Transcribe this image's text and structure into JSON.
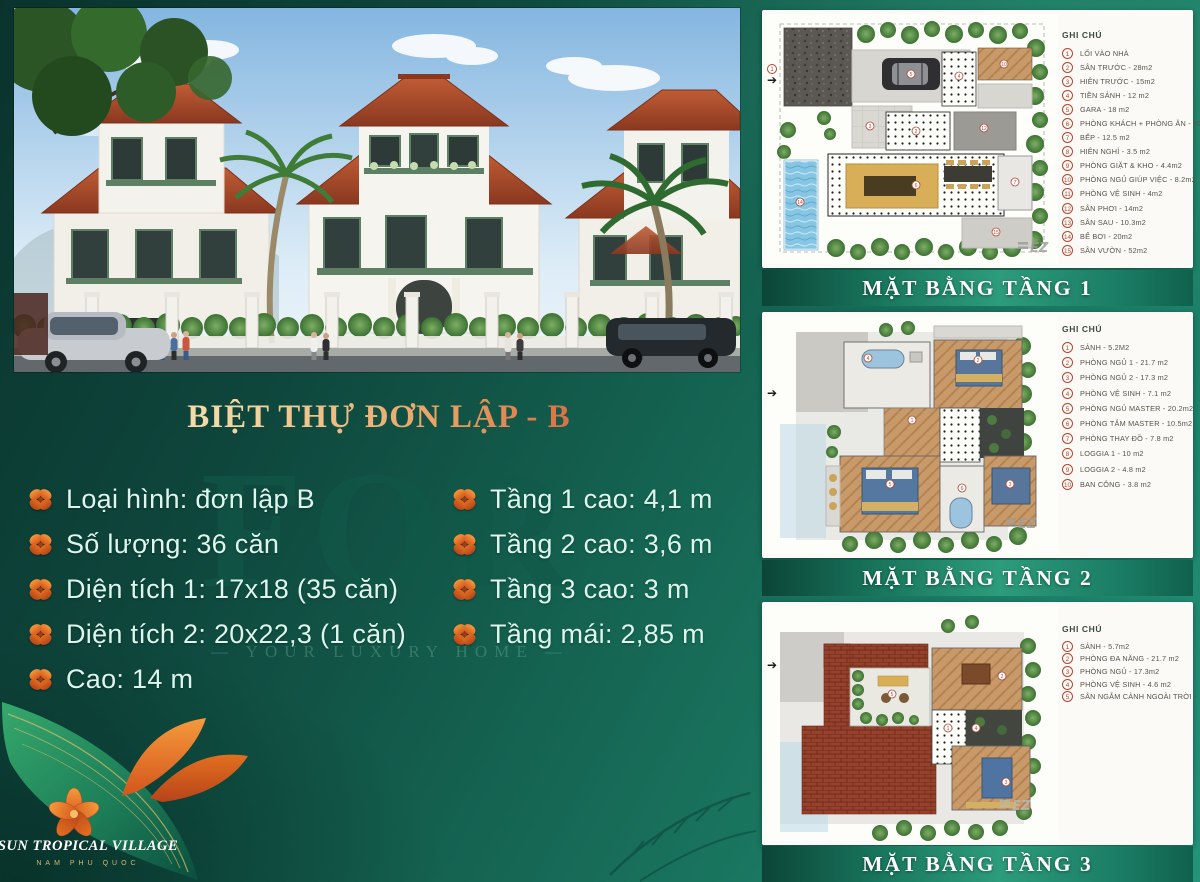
{
  "title": "BIỆT THỰ ĐƠN LẬP - B",
  "watermark": {
    "big": "FOR",
    "small": "— YOUR LUXURY HOME —"
  },
  "specs": {
    "left": [
      "Loại hình: đơn lập B",
      "Số lượng: 36 căn",
      "Diện tích 1: 17x18 (35 căn)",
      "Diện tích 2: 20x22,3 (1 căn)",
      "Cao: 14 m"
    ],
    "right": [
      "Tầng 1 cao: 4,1 m",
      "Tầng 2 cao: 3,6 m",
      "Tầng 3 cao: 3 m",
      "Tầng mái: 2,85 m"
    ]
  },
  "logo": {
    "name": "SUN TROPICAL VILLAGE",
    "subtitle": "NAM PHU QUOC"
  },
  "plans": [
    {
      "caption": "MẶT BẰNG TẦNG 1",
      "legend_title": "GHI CHÚ",
      "brand_mark": "EZ",
      "legend": [
        {
          "num": "1",
          "label": "LỐI VÀO NHÀ"
        },
        {
          "num": "2",
          "label": "SÂN TRƯỚC - 28m2"
        },
        {
          "num": "3",
          "label": "HIÊN TRƯỚC - 15m2"
        },
        {
          "num": "4",
          "label": "TIỀN SẢNH - 12 m2"
        },
        {
          "num": "5",
          "label": "GARA - 18 m2"
        },
        {
          "num": "6",
          "label": "PHÒNG KHÁCH + PHÒNG ĂN - 40 m2"
        },
        {
          "num": "7",
          "label": "BẾP - 12.5 m2"
        },
        {
          "num": "8",
          "label": "HIÊN NGHỈ - 3.5 m2"
        },
        {
          "num": "9",
          "label": "PHÒNG GIẶT & KHO - 4.4m2"
        },
        {
          "num": "10",
          "label": "PHÒNG NGỦ GIÚP VIỆC - 8.2m2"
        },
        {
          "num": "11",
          "label": "PHÒNG VỆ SINH - 4m2"
        },
        {
          "num": "12",
          "label": "SÂN PHƠI - 14m2"
        },
        {
          "num": "13",
          "label": "SÂN SAU - 10.3m2"
        },
        {
          "num": "14",
          "label": "BỂ BƠI - 20m2"
        },
        {
          "num": "15",
          "label": "SÂN VƯỜN - 52m2"
        }
      ]
    },
    {
      "caption": "MẶT BẰNG TẦNG 2",
      "legend_title": "GHI CHÚ",
      "brand_mark": "EZ",
      "legend": [
        {
          "num": "1",
          "label": "SẢNH - 5.2M2"
        },
        {
          "num": "2",
          "label": "PHÒNG NGỦ 1 - 21.7 m2"
        },
        {
          "num": "3",
          "label": "PHÒNG NGỦ 2 - 17.3 m2"
        },
        {
          "num": "4",
          "label": "PHÒNG VỆ SINH - 7.1 m2"
        },
        {
          "num": "5",
          "label": "PHÒNG NGỦ MASTER - 20.2m2"
        },
        {
          "num": "6",
          "label": "PHÒNG TẮM MASTER - 10.5m2"
        },
        {
          "num": "7",
          "label": "PHÒNG THAY ĐỒ - 7.8 m2"
        },
        {
          "num": "8",
          "label": "LOGGIA 1 - 10 m2"
        },
        {
          "num": "9",
          "label": "LOGGIA 2 - 4.8 m2"
        },
        {
          "num": "10",
          "label": "BAN CÔNG - 3.8 m2"
        }
      ]
    },
    {
      "caption": "MẶT BẰNG TẦNG 3",
      "legend_title": "GHI CHÚ",
      "brand_mark": "EZ",
      "legend": [
        {
          "num": "1",
          "label": "SẢNH - 5.7m2"
        },
        {
          "num": "2",
          "label": "PHÒNG ĐA NĂNG - 21.7 m2"
        },
        {
          "num": "3",
          "label": "PHÒNG NGỦ - 17.3m2"
        },
        {
          "num": "4",
          "label": "PHÒNG VỆ SINH - 4.6 m2"
        },
        {
          "num": "5",
          "label": "SÂN NGẮM CẢNH NGOÀI TRỜI - 17.3m2"
        }
      ]
    }
  ],
  "colors": {
    "background_teal": "#14604f",
    "accent_orange": "#e4702d",
    "legend_red": "#b5452f",
    "roof_terracotta": "#a8492e",
    "title_red": "#cf472e",
    "gold": "#d9b66e"
  }
}
